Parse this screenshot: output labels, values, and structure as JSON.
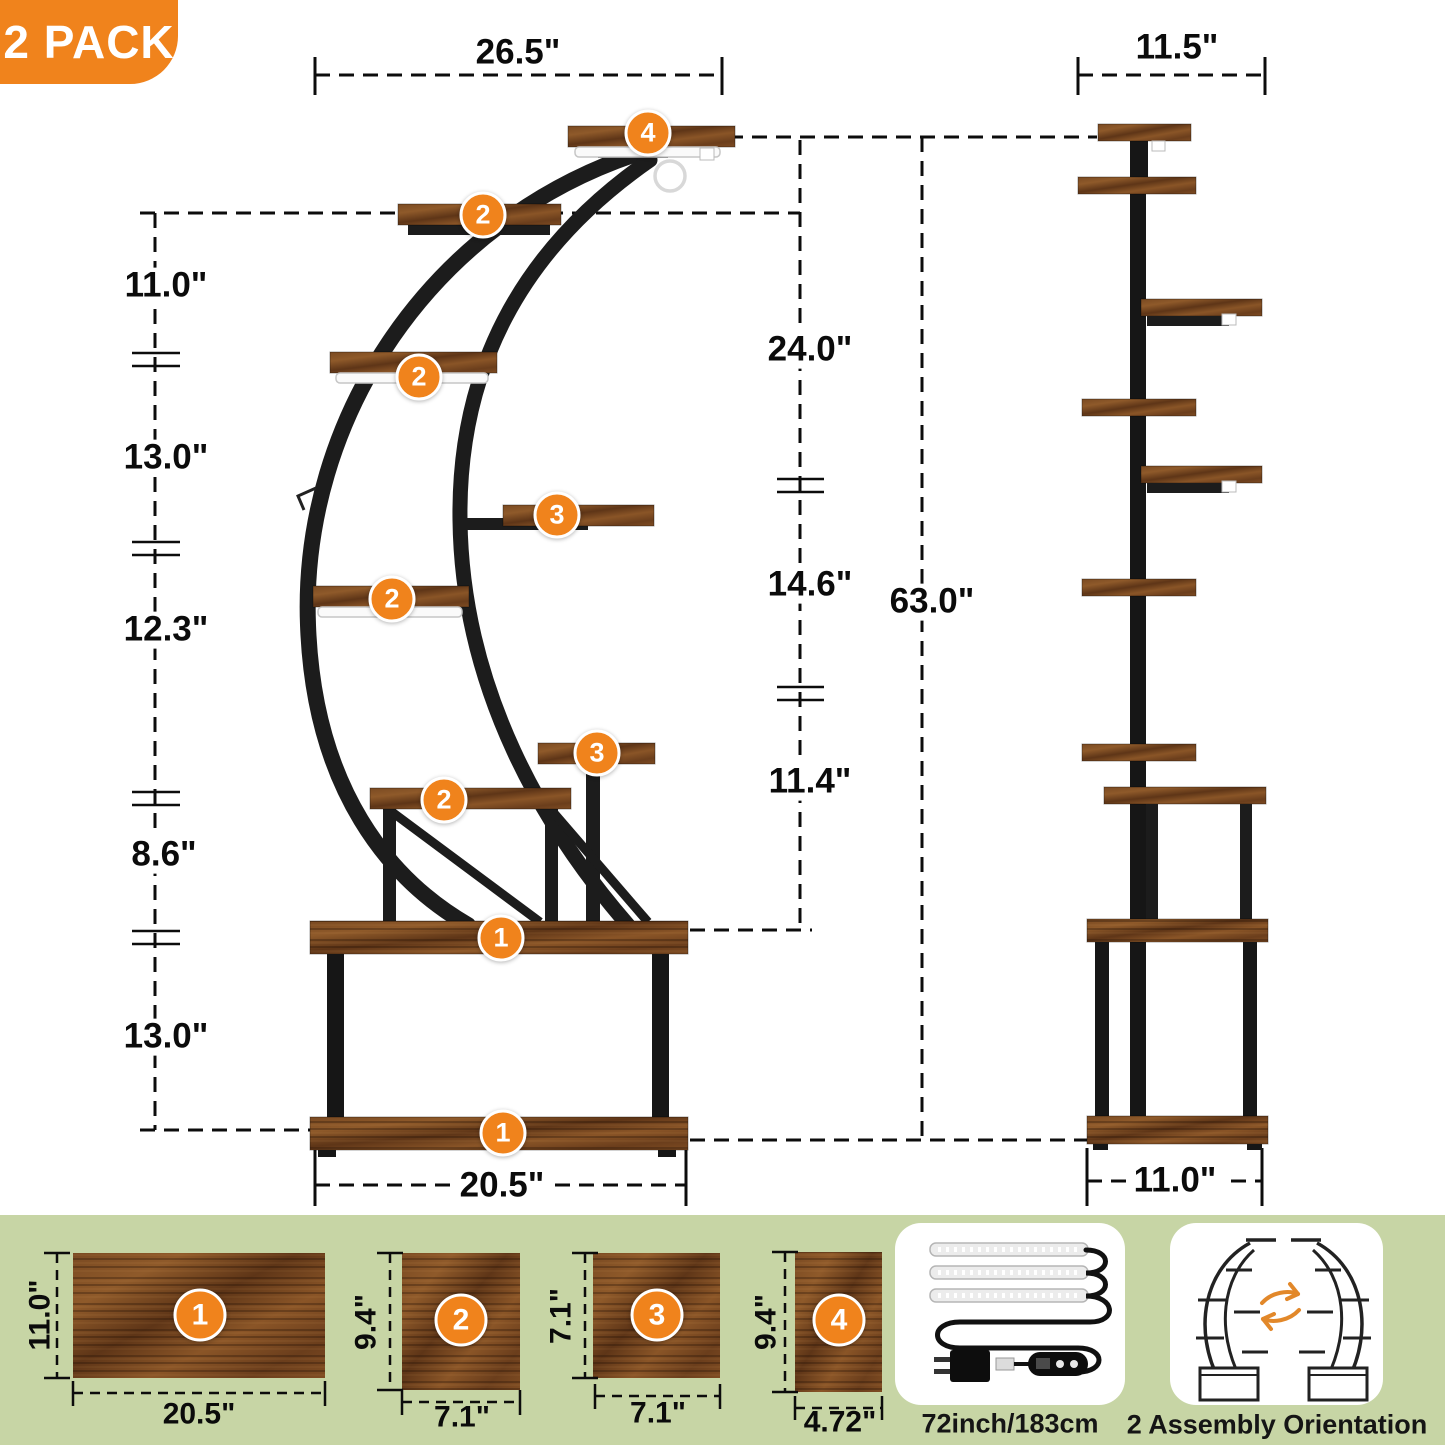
{
  "pack_badge_label": "2 PACK",
  "front_view": {
    "top_width": "26.5\"",
    "left_dims": [
      "11.0\"",
      "13.0\"",
      "12.3\"",
      "8.6\"",
      "13.0\""
    ],
    "right_dims": [
      "24.0\"",
      "14.6\"",
      "11.4\""
    ],
    "total_height": "63.0\"",
    "base_width": "20.5\"",
    "shelf_badges": [
      "4",
      "2",
      "2",
      "3",
      "2",
      "3",
      "2",
      "1",
      "1"
    ]
  },
  "side_view": {
    "top_width": "11.5\"",
    "base_width": "11.0\""
  },
  "shelf_panels": [
    {
      "num": "1",
      "width": "20.5\"",
      "depth": "11.0\""
    },
    {
      "num": "2",
      "width": "7.1\"",
      "depth": "9.4\""
    },
    {
      "num": "3",
      "width": "7.1\"",
      "depth": "7.1\""
    },
    {
      "num": "4",
      "width": "4.72\"",
      "depth": "9.4\""
    }
  ],
  "info_cards": {
    "led_strip_caption": "72inch/183cm",
    "assembly_caption": "2 Assembly Orientation"
  },
  "colors": {
    "accent_orange": "#F0831C",
    "band_green": "#C7D5A5",
    "metal_black": "#1A1A1A",
    "wood_brown": "#7A4A22"
  }
}
